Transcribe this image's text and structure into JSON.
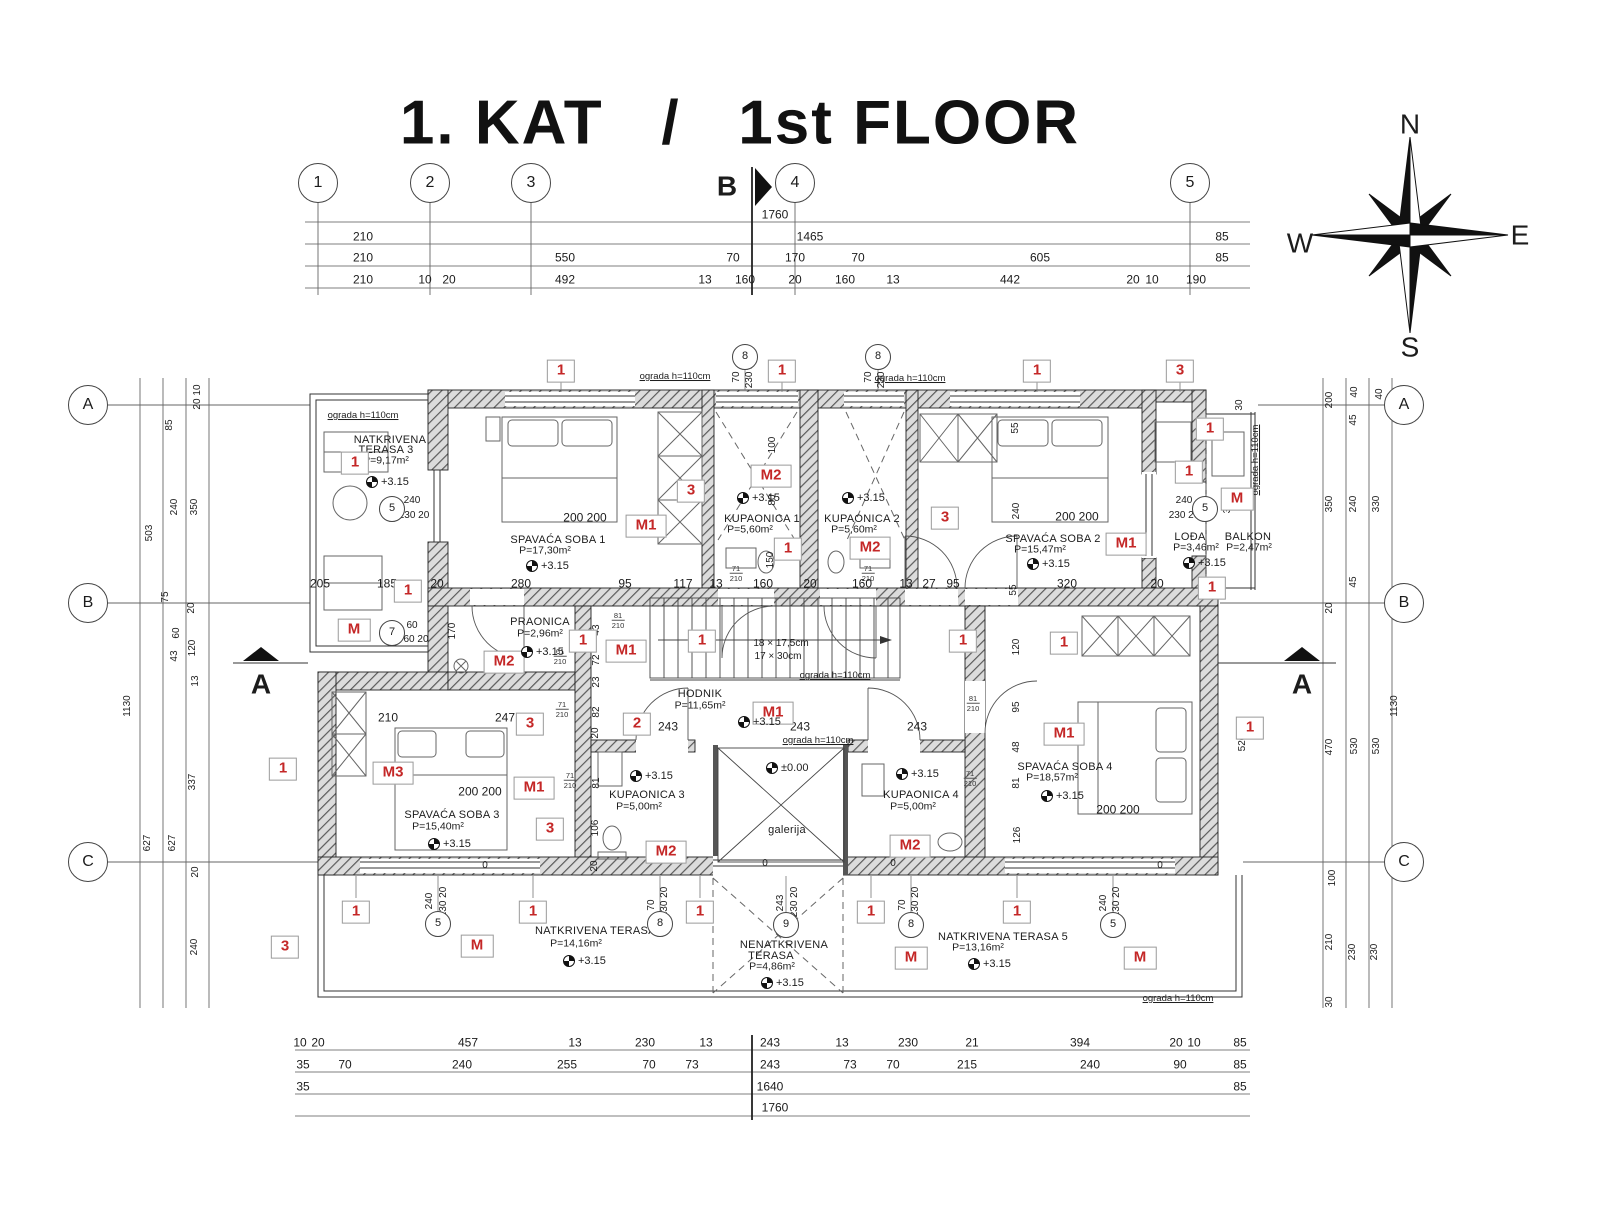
{
  "title": "1. KAT   /   1st FLOOR",
  "compass": {
    "n": "N",
    "e": "E",
    "s": "S",
    "w": "W"
  },
  "grid": {
    "top": [
      [
        "1",
        318
      ],
      [
        "2",
        430
      ],
      [
        "3",
        531
      ],
      [
        "4",
        795
      ],
      [
        "5",
        1190
      ]
    ],
    "left": [
      [
        "A",
        405
      ],
      [
        "B",
        603
      ],
      [
        "C",
        862
      ]
    ],
    "right": [
      [
        "A",
        405
      ],
      [
        "B",
        603
      ],
      [
        "C",
        862
      ]
    ]
  },
  "sections": [
    [
      "B",
      727,
      186
    ],
    [
      "A",
      261,
      684
    ],
    [
      "A",
      1302,
      684
    ]
  ],
  "dim_rows": [
    {
      "y": 215,
      "items": [
        [
          "1760",
          775
        ]
      ]
    },
    {
      "y": 237,
      "items": [
        [
          "210",
          363
        ],
        [
          "1465",
          810
        ],
        [
          "85",
          1222
        ]
      ]
    },
    {
      "y": 258,
      "items": [
        [
          "210",
          363
        ],
        [
          "550",
          565
        ],
        [
          "70",
          733
        ],
        [
          "170",
          795
        ],
        [
          "70",
          858
        ],
        [
          "605",
          1040
        ],
        [
          "85",
          1222
        ]
      ]
    },
    {
      "y": 280,
      "items": [
        [
          "210",
          363
        ],
        [
          "10",
          425
        ],
        [
          "20",
          449
        ],
        [
          "492",
          565
        ],
        [
          "13",
          705
        ],
        [
          "160",
          745
        ],
        [
          "20",
          795
        ],
        [
          "160",
          845
        ],
        [
          "13",
          893
        ],
        [
          "442",
          1010
        ],
        [
          "20",
          1133
        ],
        [
          "10",
          1152
        ],
        [
          "190",
          1196
        ]
      ]
    },
    {
      "y": 584,
      "items": [
        [
          "205",
          320
        ],
        [
          "185",
          387
        ],
        [
          "20",
          437
        ],
        [
          "280",
          521
        ],
        [
          "95",
          625
        ],
        [
          "117",
          683
        ],
        [
          "13",
          716
        ],
        [
          "160",
          763
        ],
        [
          "20",
          810
        ],
        [
          "160",
          862
        ],
        [
          "13",
          906
        ],
        [
          "27",
          929
        ],
        [
          "95",
          953
        ],
        [
          "320",
          1067
        ],
        [
          "20",
          1157
        ]
      ]
    },
    {
      "y": 1043,
      "items": [
        [
          "10",
          300
        ],
        [
          "20",
          318
        ],
        [
          "457",
          468
        ],
        [
          "13",
          575
        ],
        [
          "230",
          645
        ],
        [
          "13",
          706
        ],
        [
          "243",
          770
        ],
        [
          "13",
          842
        ],
        [
          "230",
          908
        ],
        [
          "21",
          972
        ],
        [
          "394",
          1080
        ],
        [
          "20",
          1176
        ],
        [
          "10",
          1194
        ],
        [
          "85",
          1240
        ]
      ]
    },
    {
      "y": 1065,
      "items": [
        [
          "35",
          303
        ],
        [
          "70",
          345
        ],
        [
          "240",
          462
        ],
        [
          "255",
          567
        ],
        [
          "70",
          649
        ],
        [
          "73",
          692
        ],
        [
          "243",
          770
        ],
        [
          "73",
          850
        ],
        [
          "70",
          893
        ],
        [
          "215",
          967
        ],
        [
          "240",
          1090
        ],
        [
          "90",
          1180
        ],
        [
          "85",
          1240
        ]
      ]
    },
    {
      "y": 1087,
      "items": [
        [
          "35",
          303
        ],
        [
          "1640",
          770
        ],
        [
          "85",
          1240
        ]
      ]
    },
    {
      "y": 1108,
      "items": [
        [
          "1760",
          775
        ]
      ]
    }
  ],
  "vdims": [
    [
      "10",
      198,
      390
    ],
    [
      "20",
      198,
      404
    ],
    [
      "85",
      170,
      425
    ],
    [
      "240",
      175,
      507
    ],
    [
      "350",
      195,
      507
    ],
    [
      "503",
      150,
      533
    ],
    [
      "75",
      166,
      597
    ],
    [
      "20",
      192,
      608
    ],
    [
      "60",
      177,
      633
    ],
    [
      "43",
      175,
      656
    ],
    [
      "120",
      193,
      648
    ],
    [
      "13",
      196,
      681
    ],
    [
      "1130",
      128,
      706
    ],
    [
      "337",
      193,
      782
    ],
    [
      "627",
      148,
      843
    ],
    [
      "627",
      173,
      843
    ],
    [
      "20",
      196,
      872
    ],
    [
      "240",
      195,
      947
    ],
    [
      "200",
      1330,
      400
    ],
    [
      "40",
      1355,
      392
    ],
    [
      "40",
      1380,
      394
    ],
    [
      "45",
      1354,
      420
    ],
    [
      "350",
      1330,
      504
    ],
    [
      "240",
      1354,
      504
    ],
    [
      "330",
      1377,
      504
    ],
    [
      "45",
      1354,
      582
    ],
    [
      "20",
      1330,
      608
    ],
    [
      "470",
      1330,
      747
    ],
    [
      "530",
      1355,
      746
    ],
    [
      "530",
      1377,
      746
    ],
    [
      "1130",
      1395,
      706
    ],
    [
      "100",
      1333,
      878
    ],
    [
      "210",
      1330,
      942
    ],
    [
      "230",
      1353,
      952
    ],
    [
      "230",
      1375,
      952
    ],
    [
      "30",
      1330,
      1002
    ],
    [
      "100",
      773,
      445
    ],
    [
      "80",
      773,
      500
    ],
    [
      "150",
      771,
      560
    ],
    [
      "55",
      1016,
      428
    ],
    [
      "240",
      1017,
      511
    ],
    [
      "170",
      453,
      631
    ],
    [
      "43",
      597,
      630
    ],
    [
      "72",
      597,
      660
    ],
    [
      "23",
      597,
      682
    ],
    [
      "82",
      597,
      712
    ],
    [
      "20",
      596,
      733
    ],
    [
      "81",
      597,
      783
    ],
    [
      "106",
      596,
      828
    ],
    [
      "20",
      595,
      866
    ],
    [
      "120",
      1017,
      647
    ],
    [
      "95",
      1017,
      707
    ],
    [
      "48",
      1017,
      747
    ],
    [
      "81",
      1017,
      783
    ],
    [
      "126",
      1018,
      835
    ],
    [
      "520",
      1243,
      743
    ],
    [
      "30",
      1240,
      405
    ],
    [
      "358",
      1228,
      505
    ],
    [
      "55",
      1014,
      590
    ],
    [
      "70",
      737,
      377
    ],
    [
      "230 20",
      750,
      373
    ],
    [
      "70",
      869,
      377
    ],
    [
      "230 20",
      882,
      373
    ],
    [
      "240",
      430,
      901
    ],
    [
      "230 20",
      444,
      902
    ],
    [
      "70",
      652,
      905
    ],
    [
      "230 20",
      665,
      902
    ],
    [
      "243",
      781,
      903
    ],
    [
      "230 20",
      795,
      902
    ],
    [
      "70",
      903,
      905
    ],
    [
      "230 20",
      916,
      902
    ],
    [
      "240",
      1104,
      903
    ],
    [
      "230 20",
      1117,
      902
    ],
    [
      "ograda h=110cm",
      1256,
      460,
      "og"
    ]
  ],
  "labels": [
    [
      "NATKRIVENA",
      390,
      441,
      "r"
    ],
    [
      "TERASA 3",
      386,
      451,
      "r"
    ],
    [
      "P=9,17m²",
      386,
      461,
      "a"
    ],
    [
      "SPAVAĆA SOBA 1",
      558,
      541,
      "r"
    ],
    [
      "P=17,30m²",
      545,
      551,
      "a"
    ],
    [
      "KUPAONICA 1",
      762,
      520,
      "r"
    ],
    [
      "P=5,60m²",
      750,
      530,
      "a"
    ],
    [
      "KUPAONICA 2",
      862,
      520,
      "r"
    ],
    [
      "P=5,60m²",
      854,
      530,
      "a"
    ],
    [
      "SPAVAĆA SOBA 2",
      1053,
      540,
      "r"
    ],
    [
      "P=15,47m²",
      1040,
      550,
      "a"
    ],
    [
      "LOĐA",
      1190,
      538,
      "r"
    ],
    [
      "P=3,46m²",
      1196,
      548,
      "a"
    ],
    [
      "BALKON",
      1248,
      538,
      "r"
    ],
    [
      "P=2,47m²",
      1249,
      548,
      "a"
    ],
    [
      "PRAONICA",
      540,
      623,
      "r"
    ],
    [
      "P=2,96m²",
      540,
      634,
      "a"
    ],
    [
      "HODNIK",
      700,
      695,
      "r"
    ],
    [
      "P=11,65m²",
      700,
      706,
      "a"
    ],
    [
      "galerija",
      787,
      831,
      "r"
    ],
    [
      "KUPAONICA 3",
      647,
      796,
      "r"
    ],
    [
      "P=5,00m²",
      639,
      807,
      "a"
    ],
    [
      "KUPAONICA 4",
      921,
      796,
      "r"
    ],
    [
      "P=5,00m²",
      913,
      807,
      "a"
    ],
    [
      "SPAVAĆA SOBA 3",
      452,
      816,
      "r"
    ],
    [
      "P=15,40m²",
      438,
      827,
      "a"
    ],
    [
      "SPAVAĆA SOBA 4",
      1065,
      768,
      "r"
    ],
    [
      "P=18,57m²",
      1052,
      778,
      "a"
    ],
    [
      "NATKRIVENA TERASA 4",
      600,
      932,
      "r"
    ],
    [
      "P=14,16m²",
      576,
      944,
      "a"
    ],
    [
      "NENATKRIVENA",
      784,
      946,
      "r"
    ],
    [
      "TERASA",
      771,
      957,
      "r"
    ],
    [
      "P=4,86m²",
      772,
      967,
      "a"
    ],
    [
      "NATKRIVENA TERASA 5",
      1003,
      938,
      "r"
    ],
    [
      "P=13,16m²",
      978,
      948,
      "a"
    ],
    [
      "ograda h=110cm",
      363,
      416,
      "og"
    ],
    [
      "ograda h=110cm",
      675,
      377,
      "og"
    ],
    [
      "ograda h=110cm",
      910,
      379,
      "og"
    ],
    [
      "ograda h=110cm",
      835,
      676,
      "og"
    ],
    [
      "ograda h=110cm",
      818,
      741,
      "og"
    ],
    [
      "ograda h=110cm",
      1178,
      999,
      "og"
    ],
    [
      "200 200",
      585,
      518,
      "d"
    ],
    [
      "200 200",
      1077,
      517,
      "d"
    ],
    [
      "200 200",
      480,
      792,
      "d"
    ],
    [
      "200 200",
      1118,
      810,
      "d"
    ],
    [
      "210",
      388,
      718,
      "d"
    ],
    [
      "247",
      505,
      718,
      "d"
    ],
    [
      "243",
      668,
      727,
      "d"
    ],
    [
      "243",
      800,
      727,
      "d"
    ],
    [
      "243",
      917,
      727,
      "d"
    ],
    [
      "240",
      412,
      501,
      "s"
    ],
    [
      "230 20",
      414,
      516,
      "s"
    ],
    [
      "60",
      412,
      626,
      "s"
    ],
    [
      "60 20",
      416,
      640,
      "s"
    ],
    [
      "240",
      1184,
      501,
      "s"
    ],
    [
      "230 20",
      1184,
      516,
      "s"
    ],
    [
      "18 × 17,5cm",
      781,
      644,
      "st"
    ],
    [
      "17 × 30cm",
      778,
      657,
      "st"
    ],
    [
      "0",
      485,
      866,
      "s"
    ],
    [
      "0",
      765,
      864,
      "s"
    ],
    [
      "0",
      893,
      864,
      "s"
    ],
    [
      "0",
      1160,
      866,
      "s"
    ]
  ],
  "levels": [
    [
      "+3.15",
      366,
      482
    ],
    [
      "+3.15",
      526,
      566
    ],
    [
      "+3.15",
      737,
      498
    ],
    [
      "+3.15",
      842,
      498
    ],
    [
      "+3.15",
      1027,
      564
    ],
    [
      "+3.15",
      1183,
      563
    ],
    [
      "+3.15",
      521,
      652
    ],
    [
      "+3.15",
      738,
      722
    ],
    [
      "±0.00",
      766,
      768
    ],
    [
      "+3.15",
      630,
      776
    ],
    [
      "+3.15",
      896,
      774
    ],
    [
      "+3.15",
      428,
      844
    ],
    [
      "+3.15",
      1041,
      796
    ],
    [
      "+3.15",
      563,
      961
    ],
    [
      "+3.15",
      761,
      983
    ],
    [
      "+3.15",
      968,
      964
    ]
  ],
  "red_markers": [
    [
      "1",
      561,
      371
    ],
    [
      "1",
      782,
      371
    ],
    [
      "1",
      1037,
      371
    ],
    [
      "3",
      1180,
      371
    ],
    [
      "1",
      355,
      463
    ],
    [
      "M1",
      646,
      526
    ],
    [
      "3",
      691,
      491
    ],
    [
      "M2",
      771,
      476
    ],
    [
      "1",
      788,
      549
    ],
    [
      "M2",
      870,
      548
    ],
    [
      "3",
      945,
      518
    ],
    [
      "M1",
      1126,
      544
    ],
    [
      "1",
      1210,
      429
    ],
    [
      "1",
      1189,
      472
    ],
    [
      "M",
      1237,
      499
    ],
    [
      "1",
      1212,
      588
    ],
    [
      "M",
      354,
      630
    ],
    [
      "1",
      583,
      641
    ],
    [
      "M2",
      504,
      662
    ],
    [
      "M1",
      626,
      651
    ],
    [
      "1",
      702,
      641
    ],
    [
      "1",
      963,
      641
    ],
    [
      "1",
      408,
      591
    ],
    [
      "2",
      637,
      724
    ],
    [
      "M1",
      773,
      713
    ],
    [
      "1",
      283,
      769
    ],
    [
      "M3",
      393,
      773
    ],
    [
      "M1",
      534,
      788
    ],
    [
      "3",
      530,
      724
    ],
    [
      "3",
      550,
      829
    ],
    [
      "M2",
      666,
      852
    ],
    [
      "M2",
      910,
      846
    ],
    [
      "1",
      1064,
      643
    ],
    [
      "1",
      1250,
      728
    ],
    [
      "M1",
      1064,
      734
    ],
    [
      "1",
      356,
      912
    ],
    [
      "1",
      533,
      912
    ],
    [
      "1",
      700,
      912
    ],
    [
      "1",
      871,
      912
    ],
    [
      "1",
      1017,
      912
    ],
    [
      "M",
      477,
      946
    ],
    [
      "M",
      911,
      958
    ],
    [
      "M",
      1140,
      958
    ],
    [
      "3",
      285,
      947
    ]
  ],
  "ref_circles": [
    [
      "5",
      392,
      509
    ],
    [
      "7",
      392,
      633
    ],
    [
      "8",
      745,
      357
    ],
    [
      "8",
      878,
      357
    ],
    [
      "5",
      1205,
      509
    ],
    [
      "5",
      438,
      924
    ],
    [
      "8",
      660,
      924
    ],
    [
      "9",
      786,
      925
    ],
    [
      "8",
      911,
      925
    ],
    [
      "5",
      1113,
      925
    ]
  ],
  "door_tags": [
    [
      "71",
      "210",
      736,
      574
    ],
    [
      "71",
      "210",
      868,
      574
    ],
    [
      "61",
      "210",
      560,
      657
    ],
    [
      "71",
      "210",
      562,
      710
    ],
    [
      "71",
      "210",
      570,
      781
    ],
    [
      "81",
      "210",
      618,
      621
    ],
    [
      "81",
      "210",
      973,
      704
    ],
    [
      "71",
      "210",
      970,
      779
    ]
  ]
}
